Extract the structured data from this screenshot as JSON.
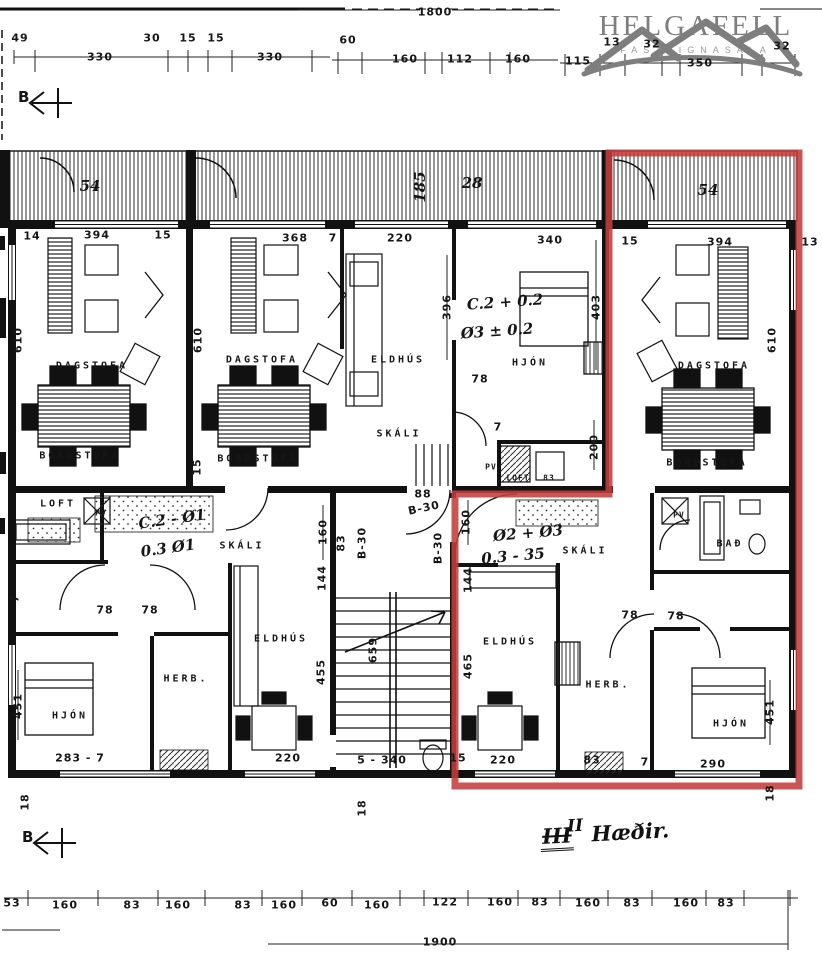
{
  "colors": {
    "highlight_red": "#c43c3c",
    "ink": "#161616",
    "logo_gray": "#828282",
    "paper": "#ffffff"
  },
  "logo": {
    "name": "HELGAFELL",
    "tagline": "FASTEIGNASALA"
  },
  "section_marker": {
    "top": "B",
    "bottom": "B"
  },
  "floor_note": {
    "struck": "III",
    "replacement": "II",
    "text": "Hæðir."
  },
  "plan": {
    "labels": [
      {
        "n": "dim-overall-top",
        "t": "1800",
        "x": 435,
        "y": 12
      },
      {
        "n": "dim-49",
        "t": "49",
        "x": 20,
        "y": 38
      },
      {
        "n": "dim-330-a",
        "t": "330",
        "x": 100,
        "y": 57
      },
      {
        "n": "dim-30",
        "t": "30",
        "x": 152,
        "y": 38
      },
      {
        "n": "dim-15-a",
        "t": "15",
        "x": 188,
        "y": 38
      },
      {
        "n": "dim-15-b",
        "t": "15",
        "x": 216,
        "y": 38
      },
      {
        "n": "dim-330-b",
        "t": "330",
        "x": 270,
        "y": 57
      },
      {
        "n": "dim-60-a",
        "t": "60",
        "x": 348,
        "y": 40
      },
      {
        "n": "dim-160-a",
        "t": "160",
        "x": 405,
        "y": 59
      },
      {
        "n": "dim-112",
        "t": "112",
        "x": 460,
        "y": 59
      },
      {
        "n": "dim-160-b",
        "t": "160",
        "x": 518,
        "y": 59
      },
      {
        "n": "dim-115",
        "t": "115",
        "x": 578,
        "y": 61
      },
      {
        "n": "dim-13-a",
        "t": "13",
        "x": 612,
        "y": 42
      },
      {
        "n": "dim-32-a",
        "t": "32",
        "x": 652,
        "y": 44
      },
      {
        "n": "dim-350",
        "t": "350",
        "x": 700,
        "y": 63
      },
      {
        "n": "dim-32-b",
        "t": "32",
        "x": 782,
        "y": 46
      },
      {
        "n": "dim-14",
        "t": "14",
        "x": 32,
        "y": 236
      },
      {
        "n": "dim-394-left",
        "t": "394",
        "x": 97,
        "y": 235
      },
      {
        "n": "dim-15-left",
        "t": "15",
        "x": 163,
        "y": 235
      },
      {
        "n": "dim-368",
        "t": "368",
        "x": 295,
        "y": 238
      },
      {
        "n": "dim-7-mid",
        "t": "7",
        "x": 333,
        "y": 238
      },
      {
        "n": "dim-220-mid",
        "t": "220",
        "x": 400,
        "y": 238
      },
      {
        "n": "dim-340",
        "t": "340",
        "x": 550,
        "y": 240
      },
      {
        "n": "dim-15-right",
        "t": "15",
        "x": 630,
        "y": 241
      },
      {
        "n": "dim-394-right",
        "t": "394",
        "x": 720,
        "y": 242
      },
      {
        "n": "dim-13-b",
        "t": "13",
        "x": 810,
        "y": 242
      },
      {
        "n": "dim-610-left",
        "t": "610",
        "x": 18,
        "y": 340,
        "r": -90
      },
      {
        "n": "dim-610-mid",
        "t": "610",
        "x": 198,
        "y": 340,
        "r": -90
      },
      {
        "n": "dim-396",
        "t": "396",
        "x": 447,
        "y": 307,
        "r": -90
      },
      {
        "n": "dim-403",
        "t": "403",
        "x": 596,
        "y": 307,
        "r": -90
      },
      {
        "n": "dim-610-right",
        "t": "610",
        "x": 772,
        "y": 340,
        "r": -90
      },
      {
        "n": "dim-200",
        "t": "200",
        "x": 594,
        "y": 447,
        "r": -90
      },
      {
        "n": "dim-15-v",
        "t": "15",
        "x": 197,
        "y": 467,
        "r": -90
      },
      {
        "n": "dim-160-v",
        "t": "160",
        "x": 323,
        "y": 532,
        "r": -90
      },
      {
        "n": "dim-83-v",
        "t": "83",
        "x": 341,
        "y": 543,
        "r": -90
      },
      {
        "n": "dim-144-a",
        "t": "144",
        "x": 322,
        "y": 578,
        "r": -90
      },
      {
        "n": "dim-455",
        "t": "455",
        "x": 321,
        "y": 672,
        "r": -90
      },
      {
        "n": "dim-659",
        "t": "659",
        "x": 373,
        "y": 650,
        "r": -90
      },
      {
        "n": "dim-451-left",
        "t": "451",
        "x": 18,
        "y": 706,
        "r": -90
      },
      {
        "n": "dim-451-right",
        "t": "451",
        "x": 770,
        "y": 712,
        "r": -90
      },
      {
        "n": "dim-465",
        "t": "465",
        "x": 468,
        "y": 666,
        "r": -90
      },
      {
        "n": "dim-160-red",
        "t": "160",
        "x": 466,
        "y": 522,
        "r": -90
      },
      {
        "n": "dim-144-b",
        "t": "144",
        "x": 468,
        "y": 580,
        "r": -90
      },
      {
        "n": "dim-18-left",
        "t": "18",
        "x": 25,
        "y": 802,
        "r": -90
      },
      {
        "n": "dim-18-right",
        "t": "18",
        "x": 770,
        "y": 793,
        "r": -90
      },
      {
        "n": "dim-18-mid",
        "t": "18",
        "x": 362,
        "y": 808,
        "r": -90
      },
      {
        "n": "dim-7-left-edge",
        "t": "7",
        "x": 15,
        "y": 598,
        "r": -90
      },
      {
        "n": "dim-88",
        "t": "88",
        "x": 423,
        "y": 494
      },
      {
        "n": "dim-b30-a",
        "t": "B-30",
        "x": 424,
        "y": 508,
        "r": -12
      },
      {
        "n": "dim-b30-b",
        "t": "B-30",
        "x": 362,
        "y": 543,
        "r": -90
      },
      {
        "n": "dim-b30-c",
        "t": "B-30",
        "x": 438,
        "y": 548,
        "r": -90
      },
      {
        "n": "dim-78-a",
        "t": "78",
        "x": 480,
        "y": 379
      },
      {
        "n": "dim-7-a",
        "t": "7",
        "x": 498,
        "y": 427
      },
      {
        "n": "dim-78-b",
        "t": "78",
        "x": 105,
        "y": 610
      },
      {
        "n": "dim-78-c",
        "t": "78",
        "x": 150,
        "y": 610
      },
      {
        "n": "dim-78-d",
        "t": "78",
        "x": 630,
        "y": 615
      },
      {
        "n": "dim-78-e",
        "t": "78",
        "x": 676,
        "y": 616
      },
      {
        "n": "dim-7-b",
        "t": "7",
        "x": 645,
        "y": 762
      },
      {
        "n": "dim-283-7",
        "t": "283 - 7",
        "x": 80,
        "y": 758
      },
      {
        "n": "dim-220-a",
        "t": "220",
        "x": 288,
        "y": 758
      },
      {
        "n": "dim-5-340",
        "t": "5 - 340",
        "x": 382,
        "y": 760
      },
      {
        "n": "dim-15-c",
        "t": "15",
        "x": 458,
        "y": 758
      },
      {
        "n": "dim-220-b",
        "t": "220",
        "x": 503,
        "y": 760
      },
      {
        "n": "dim-83-a",
        "t": "83",
        "x": 592,
        "y": 760
      },
      {
        "n": "dim-290",
        "t": "290",
        "x": 713,
        "y": 764
      },
      {
        "n": "dim-53",
        "t": "53",
        "x": 12,
        "y": 903
      },
      {
        "n": "dim-160-c",
        "t": "160",
        "x": 65,
        "y": 905
      },
      {
        "n": "dim-83-b",
        "t": "83",
        "x": 132,
        "y": 905
      },
      {
        "n": "dim-160-d",
        "t": "160",
        "x": 178,
        "y": 905
      },
      {
        "n": "dim-83-c",
        "t": "83",
        "x": 243,
        "y": 905
      },
      {
        "n": "dim-160-e",
        "t": "160",
        "x": 284,
        "y": 905
      },
      {
        "n": "dim-60-b",
        "t": "60",
        "x": 330,
        "y": 903
      },
      {
        "n": "dim-160-f",
        "t": "160",
        "x": 377,
        "y": 905
      },
      {
        "n": "dim-122",
        "t": "122",
        "x": 445,
        "y": 902
      },
      {
        "n": "dim-160-g",
        "t": "160",
        "x": 500,
        "y": 902
      },
      {
        "n": "dim-83-d",
        "t": "83",
        "x": 540,
        "y": 902
      },
      {
        "n": "dim-160-h",
        "t": "160",
        "x": 588,
        "y": 903
      },
      {
        "n": "dim-83-e",
        "t": "83",
        "x": 632,
        "y": 903
      },
      {
        "n": "dim-160-i",
        "t": "160",
        "x": 686,
        "y": 903
      },
      {
        "n": "dim-83-f",
        "t": "83",
        "x": 726,
        "y": 903
      },
      {
        "n": "dim-overall-bottom",
        "t": "1900",
        "x": 440,
        "y": 942
      },
      {
        "n": "room-dagstofa-left",
        "t": "DAGSTOFA",
        "x": 92,
        "y": 366,
        "k": "room"
      },
      {
        "n": "room-bordstofa-left",
        "t": "BORDSTOFA",
        "x": 80,
        "y": 456,
        "k": "room"
      },
      {
        "n": "room-dagstofa-mid",
        "t": "DAGSTOFA",
        "x": 262,
        "y": 360,
        "k": "room"
      },
      {
        "n": "room-bordstofa-mid",
        "t": "BORDSTOFA",
        "x": 258,
        "y": 459,
        "k": "room"
      },
      {
        "n": "room-eldhus-mid",
        "t": "ELDHÚS",
        "x": 398,
        "y": 360,
        "k": "room"
      },
      {
        "n": "room-skali-mid",
        "t": "SKÁLI",
        "x": 399,
        "y": 434,
        "k": "room"
      },
      {
        "n": "room-hjon-mid",
        "t": "HJÓN",
        "x": 530,
        "y": 363,
        "k": "room"
      },
      {
        "n": "room-dagstofa-right",
        "t": "DAGSTOFA",
        "x": 714,
        "y": 366,
        "k": "room"
      },
      {
        "n": "room-bordstofa-right",
        "t": "BORDSTOFA",
        "x": 707,
        "y": 463,
        "k": "room"
      },
      {
        "n": "room-loft",
        "t": "LOFT",
        "x": 58,
        "y": 504,
        "k": "room"
      },
      {
        "n": "room-skali-left",
        "t": "SKÁLI",
        "x": 242,
        "y": 546,
        "k": "room"
      },
      {
        "n": "room-eldhus-left",
        "t": "ELDHÚS",
        "x": 281,
        "y": 639,
        "k": "room"
      },
      {
        "n": "room-herb-left",
        "t": "HERB.",
        "x": 186,
        "y": 679,
        "k": "room"
      },
      {
        "n": "room-hjon-left",
        "t": "HJÓN",
        "x": 70,
        "y": 716,
        "k": "room"
      },
      {
        "n": "room-skali-red",
        "t": "SKÁLI",
        "x": 585,
        "y": 551,
        "k": "room"
      },
      {
        "n": "room-eldhus-red",
        "t": "ELDHÚS",
        "x": 510,
        "y": 642,
        "k": "room"
      },
      {
        "n": "room-herb-red",
        "t": "HERB.",
        "x": 608,
        "y": 685,
        "k": "room"
      },
      {
        "n": "room-hjon-red",
        "t": "HJÓN",
        "x": 731,
        "y": 724,
        "k": "room"
      },
      {
        "n": "room-bad-red",
        "t": "BAÐ",
        "x": 730,
        "y": 544,
        "k": "room"
      },
      {
        "n": "label-pv-left",
        "t": "PV",
        "x": 101,
        "y": 513,
        "k": "tiny"
      },
      {
        "n": "label-pv-mid",
        "t": "PV",
        "x": 491,
        "y": 467,
        "k": "tiny"
      },
      {
        "n": "label-pv-red",
        "t": "PV",
        "x": 679,
        "y": 515,
        "k": "tiny"
      },
      {
        "n": "label-loft-mid",
        "t": "LOFT",
        "x": 518,
        "y": 478,
        "k": "tiny"
      },
      {
        "n": "dim-83-mid",
        "t": "83",
        "x": 549,
        "y": 478,
        "k": "tiny"
      },
      {
        "n": "note-c2-02",
        "t": "C.2 + 0.2",
        "x": 505,
        "y": 302,
        "k": "hand",
        "r": -4
      },
      {
        "n": "note-o3-02",
        "t": "Ø3 ± 0.2",
        "x": 497,
        "y": 331,
        "k": "hand",
        "r": -4
      },
      {
        "n": "note-c2-o1",
        "t": "C.2 - Ø1",
        "x": 172,
        "y": 519,
        "k": "hand",
        "r": -8
      },
      {
        "n": "note-03-o1",
        "t": "0.3 Ø1",
        "x": 168,
        "y": 548,
        "k": "hand",
        "r": -8
      },
      {
        "n": "note-o2-o3",
        "t": "Ø2 + Ø3",
        "x": 528,
        "y": 533,
        "k": "hand",
        "r": -5
      },
      {
        "n": "note-03-35",
        "t": "0.3 - 35",
        "x": 513,
        "y": 556,
        "k": "hand",
        "r": -5
      },
      {
        "n": "balcony-mark-54-left",
        "t": "54",
        "x": 90,
        "y": 186,
        "k": "hand"
      },
      {
        "n": "balcony-mark-185",
        "t": "185",
        "x": 420,
        "y": 187,
        "r": -90,
        "k": "hand"
      },
      {
        "n": "balcony-mark-28",
        "t": "28",
        "x": 472,
        "y": 183,
        "k": "hand"
      },
      {
        "n": "balcony-mark-54-right",
        "t": "54",
        "x": 708,
        "y": 190,
        "k": "hand"
      }
    ]
  }
}
